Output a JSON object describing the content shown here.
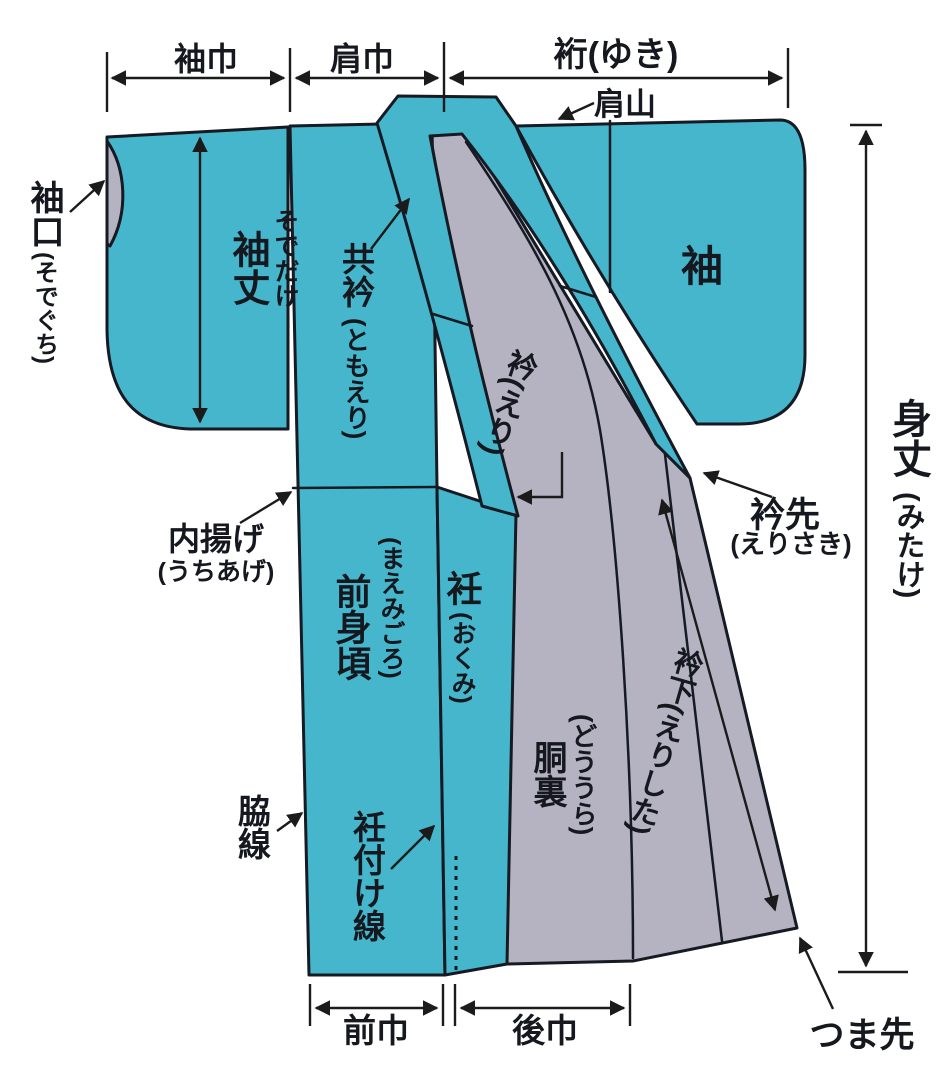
{
  "colors": {
    "fabric_teal": "#45b6cb",
    "lining_gray": "#b5b2c1",
    "accent_red": "#e8150b",
    "line_black": "#151a23"
  },
  "measurements": {
    "sode_haba": "袖巾",
    "kata_haba": "肩巾",
    "yuki": "裄(ゆき)",
    "sode_take_kanji": "袖丈",
    "sode_take_kana": "そでだけ",
    "mitake_kanji": "身丈",
    "mitake_kana": "(みたけ)",
    "mae_haba": "前巾",
    "ushiro_haba": "後巾",
    "eri_shita": "衿下(えりした)"
  },
  "parts": {
    "kata_yama": "肩山",
    "sode_guchi_kanji": "袖口",
    "sode_guchi_kana": "(そでぐち)",
    "tomoeri_kanji": "共衿",
    "tomoeri_kana": "(ともえり)",
    "eri": "衿(えり)",
    "sode": "袖",
    "eri_saki_kanji": "衿先",
    "eri_saki_kana": "(えりさき)",
    "uchiage_kanji": "内揚げ",
    "uchiage_kana": "(うちあげ)",
    "mae_migoro_kanji": "前身頃",
    "mae_migoro_kana": "(まえみごろ)",
    "okumi_kanji": "衽",
    "okumi_kana": "(おくみ)",
    "dou_ura_kanji": "胴裏",
    "dou_ura_kana": "(どううら)",
    "waki_sen": "脇線",
    "okumi_tsuke_sen": "衽付け線",
    "tsuma_saki": "つま先"
  }
}
